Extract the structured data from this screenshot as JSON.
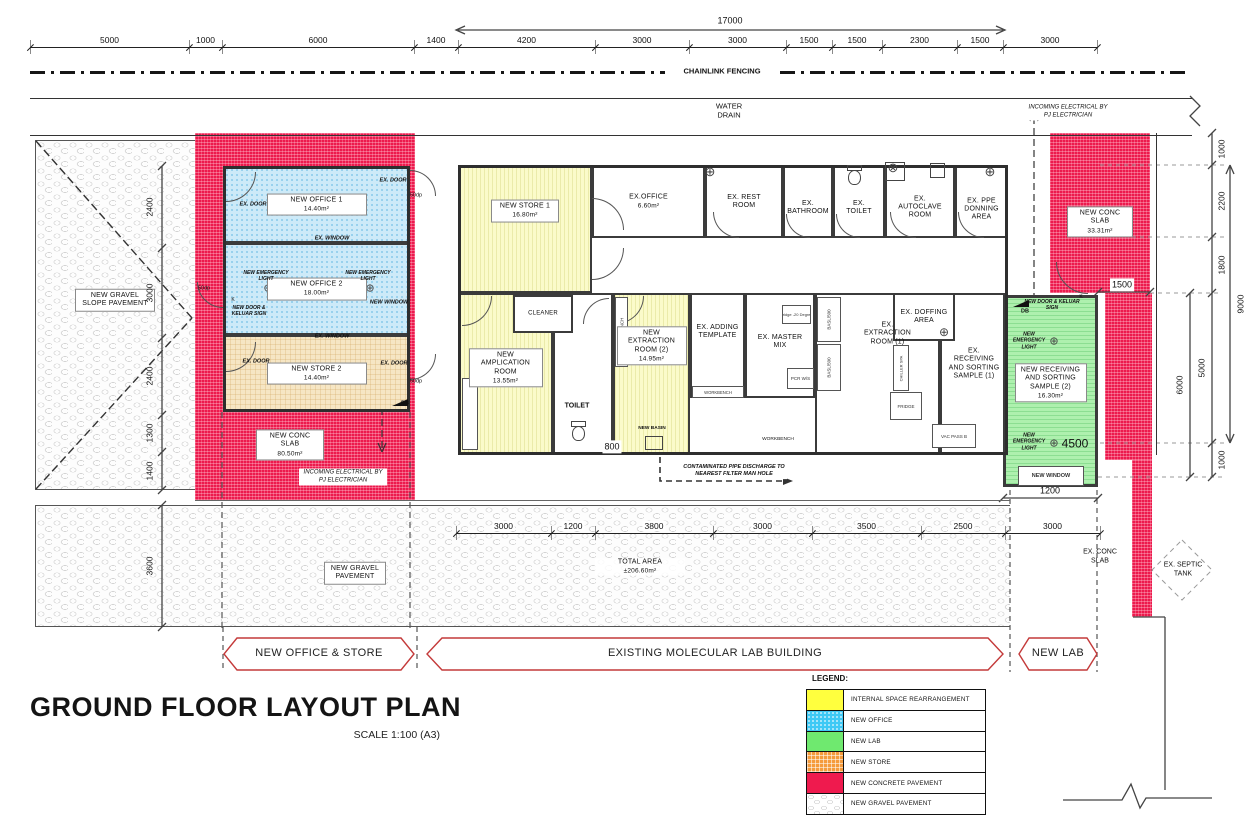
{
  "title": {
    "main": "GROUND FLOOR LAYOUT PLAN",
    "scale": "SCALE 1:100 (A3)"
  },
  "banners": [
    {
      "label": "NEW OFFICE & STORE"
    },
    {
      "label": "EXISTING MOLECULAR LAB BUILDING"
    },
    {
      "label": "NEW LAB"
    }
  ],
  "legend": {
    "title": "LEGEND:",
    "items": [
      {
        "label": "INTERNAL SPACE REARRANGEMENT",
        "color": "#ffff3e",
        "pattern": "yellow"
      },
      {
        "label": "NEW OFFICE",
        "color": "#3ec9f5",
        "pattern": "office"
      },
      {
        "label": "NEW LAB",
        "color": "#6fe96f",
        "pattern": "lab"
      },
      {
        "label": "NEW STORE",
        "color": "#f59b3c",
        "pattern": "store"
      },
      {
        "label": "NEW CONCRETE PAVEMENT",
        "color": "#ef1a4e",
        "pattern": "red"
      },
      {
        "label": "NEW GRAVEL PAVEMENT",
        "color": "#e9e9e9",
        "pattern": "gravel"
      }
    ]
  },
  "rooms": {
    "new_office1": {
      "name": "NEW OFFICE 1",
      "area": "14.40m²"
    },
    "new_office2": {
      "name": "NEW OFFICE 2",
      "area": "18.00m²"
    },
    "new_store2": {
      "name": "NEW STORE 2",
      "area": "14.40m²"
    },
    "new_store1": {
      "name": "NEW STORE 1",
      "area": "16.80m²"
    },
    "ex_office": {
      "name": "EX.OFFICE",
      "area": "6.60m²"
    },
    "ex_rest_room": {
      "name": "EX. REST ROOM"
    },
    "ex_bathroom": {
      "name": "EX. BATHROOM"
    },
    "ex_toilet": {
      "name": "EX. TOILET"
    },
    "ex_autoclave": {
      "name": "EX. AUTOCLAVE ROOM"
    },
    "ex_ppe_donning": {
      "name": "EX. PPE DONNING AREA"
    },
    "new_amplication": {
      "name": "NEW AMPLICATION ROOM",
      "area": "13.55m²"
    },
    "cleaner": {
      "name": "CLEANER"
    },
    "new_extraction2": {
      "name": "NEW EXTRACTION ROOM (2)",
      "area": "14.95m²"
    },
    "ex_adding_template": {
      "name": "EX. ADDING TEMPLATE"
    },
    "ex_master_mix": {
      "name": "EX. MASTER MIX"
    },
    "ex_extraction1": {
      "name": "EX. EXTRACTION ROOM (1)"
    },
    "ex_doffing": {
      "name": "EX. DOFFING AREA"
    },
    "ex_receiving1": {
      "name": "EX. RECEIVING AND SORTING SAMPLE (1)"
    },
    "new_receiving2": {
      "name": "NEW RECEIVING AND SORTING SAMPLE (2)",
      "area": "16.30m²"
    }
  },
  "areas": {
    "gravel_slope": {
      "name": "NEW GRAVEL SLOPE PAVEMENT"
    },
    "conc_slab_left": {
      "name": "NEW CONC SLAB",
      "area": "80.50m²"
    },
    "conc_slab_right": {
      "name": "NEW CONC SLAB",
      "area": "33.31m²"
    },
    "gravel_pavement": {
      "name": "NEW GRAVEL PAVEMENT"
    },
    "total_area": {
      "name": "TOTAL AREA",
      "area": "±206.60m²"
    }
  },
  "labels": {
    "chainlink": "CHAINLINK FENCING",
    "water_drain": "WATER DRAIN",
    "incoming_elec": "INCOMING ELECTRICAL BY PJ ELECTRICIAN",
    "contaminated": "CONTAMINATED PIPE DISCHARGE TO NEAREST FILTER MAN HOLE",
    "ex_door": "EX. DOOR",
    "ex_window": "EX. WINDOW",
    "new_window": "NEW WINDOW",
    "new_door_keluar": "NEW DOOR & KELUAR SIGN",
    "new_emergency_light": "NEW EMERGENCY LIGHT",
    "dp50": "50dp",
    "k": "K",
    "db": "DB",
    "toilet": "TOILET",
    "new_basin": "NEW BASIN",
    "workbench": "WORKBENCH",
    "fridge20": "Fridge -20 Degree",
    "pcr_ws": "PCR W/S",
    "basl": "BASL/500",
    "chiller": "CHILLER SPA",
    "fridge": "FRIDGE",
    "vac_pass": "VAC PASS B",
    "ex_conc_slab": "EX. CONC SLAB",
    "ex_septic": "EX. SEPTIC TANK"
  },
  "dims": {
    "top": [
      "5000",
      "1000",
      "6000",
      "1400",
      "4200",
      "3000",
      "3000",
      "1500",
      "1500",
      "2300",
      "1500",
      "3000"
    ],
    "bottom": [
      "3000",
      "1200",
      "3800",
      "3000",
      "3500",
      "2500",
      "3000"
    ],
    "left": [
      "2400",
      "3000",
      "2400",
      "1300",
      "1400"
    ],
    "left_lower": "3600",
    "right": [
      "1000",
      "2200",
      "1800",
      "5000",
      "1000"
    ],
    "right_6000": "6000",
    "right_9000": "9000",
    "misc": {
      "d17000": "17000",
      "d800": "800",
      "d1200": "1200",
      "d1500": "1500",
      "d4500": "4500"
    }
  }
}
